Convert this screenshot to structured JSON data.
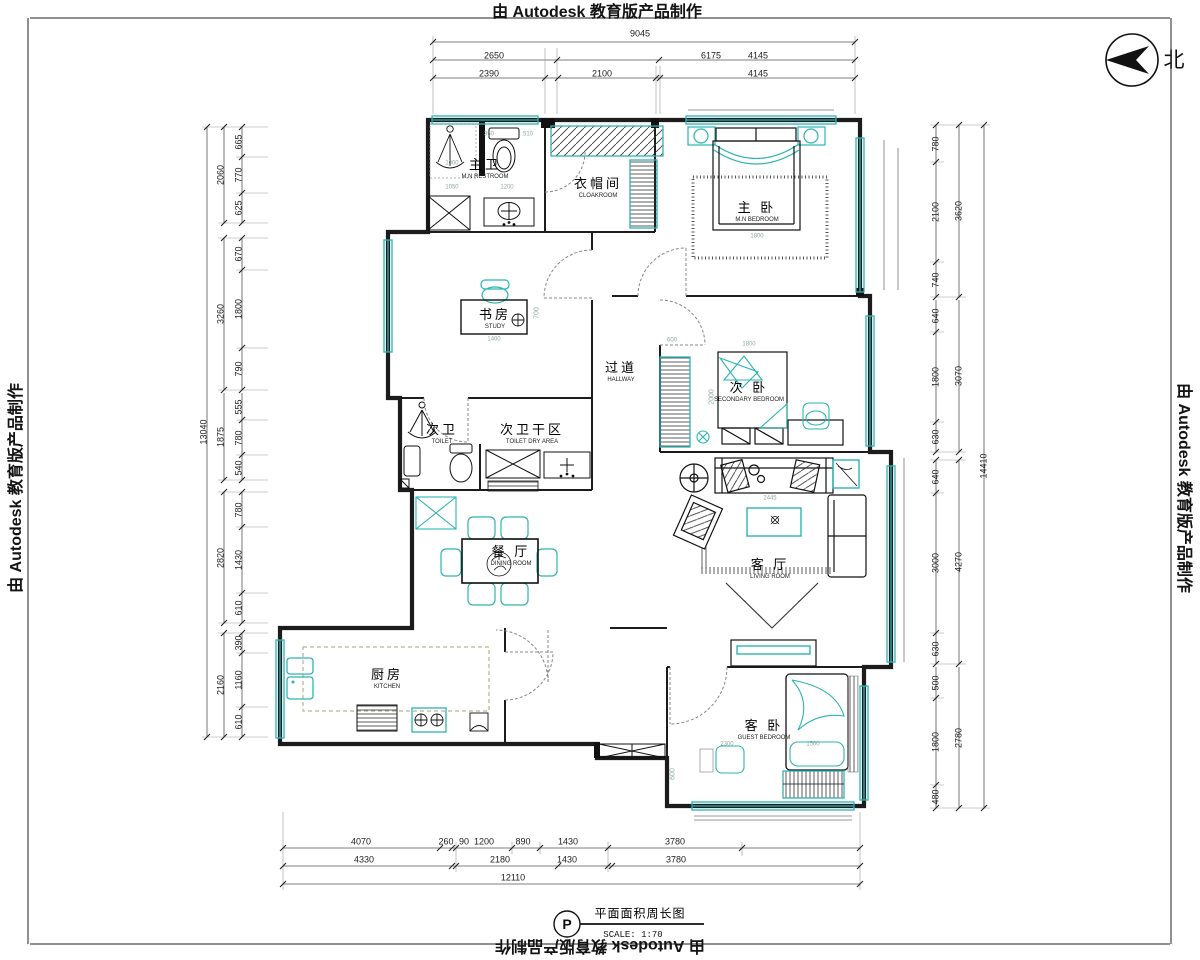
{
  "watermark": {
    "text": "由 Autodesk 教育版产品制作"
  },
  "north": {
    "label": "北"
  },
  "title_block": {
    "symbol": "P",
    "name": "平面面积周长图",
    "scale": "SCALE: 1:70"
  },
  "colors": {
    "furniture": "#2db3b3",
    "walls": "#1c1c1c",
    "dims": "#555555"
  },
  "rooms": [
    {
      "id": "master-restroom",
      "cn": "主卫",
      "en": "M.N RESTROOM",
      "x": 485,
      "y": 169
    },
    {
      "id": "cloakroom",
      "cn": "衣帽间",
      "en": "CLOAKROOM",
      "x": 598,
      "y": 188
    },
    {
      "id": "master-bedroom",
      "cn": "主 卧",
      "en": "M.N BEDROOM",
      "x": 757,
      "y": 212
    },
    {
      "id": "study",
      "cn": "书房",
      "en": "STUDY",
      "x": 495,
      "y": 319
    },
    {
      "id": "hallway",
      "cn": "过道",
      "en": "HALLWAY",
      "x": 621,
      "y": 372
    },
    {
      "id": "secondary-bedroom",
      "cn": "次 卧",
      "en": "SECONDARY BEDROOM",
      "x": 749,
      "y": 392
    },
    {
      "id": "second-toilet",
      "cn": "次卫",
      "en": "TOILET",
      "x": 442,
      "y": 434
    },
    {
      "id": "toilet-dry-area",
      "cn": "次卫干区",
      "en": "TOILET DRY AREA",
      "x": 532,
      "y": 434
    },
    {
      "id": "dining-room",
      "cn": "餐 厅",
      "en": "DINING ROOM",
      "x": 511,
      "y": 556
    },
    {
      "id": "living-room",
      "cn": "客 厅",
      "en": "LIVING ROOM",
      "x": 770,
      "y": 569
    },
    {
      "id": "kitchen",
      "cn": "厨房",
      "en": "KITCHEN",
      "x": 387,
      "y": 679
    },
    {
      "id": "guest-bedroom",
      "cn": "客 卧",
      "en": "GUEST BEDROOM",
      "x": 764,
      "y": 730
    }
  ],
  "dims": {
    "top": [
      {
        "t": "9045",
        "x": 640,
        "y": 34
      },
      {
        "t": "2650",
        "x": 494,
        "y": 56
      },
      {
        "t": "6175",
        "x": 711,
        "y": 56
      },
      {
        "t": "4145",
        "x": 758,
        "y": 56
      },
      {
        "t": "2390",
        "x": 489,
        "y": 74
      },
      {
        "t": "2100",
        "x": 602,
        "y": 74
      },
      {
        "t": "4145",
        "x": 758,
        "y": 74
      }
    ],
    "left": [
      {
        "t": "13040",
        "x": 204,
        "y": 432,
        "r": -90
      },
      {
        "t": "2060",
        "x": 221,
        "y": 175,
        "r": -90
      },
      {
        "t": "3260",
        "x": 221,
        "y": 314,
        "r": -90
      },
      {
        "t": "1875",
        "x": 221,
        "y": 437,
        "r": -90
      },
      {
        "t": "2820",
        "x": 221,
        "y": 558,
        "r": -90
      },
      {
        "t": "2160",
        "x": 221,
        "y": 685,
        "r": -90
      },
      {
        "t": "665",
        "x": 239,
        "y": 142,
        "r": -90
      },
      {
        "t": "770",
        "x": 239,
        "y": 175,
        "r": -90
      },
      {
        "t": "625",
        "x": 239,
        "y": 208,
        "r": -90
      },
      {
        "t": "670",
        "x": 239,
        "y": 254,
        "r": -90
      },
      {
        "t": "1800",
        "x": 239,
        "y": 309,
        "r": -90
      },
      {
        "t": "790",
        "x": 239,
        "y": 369,
        "r": -90
      },
      {
        "t": "555",
        "x": 239,
        "y": 407,
        "r": -90
      },
      {
        "t": "780",
        "x": 239,
        "y": 438,
        "r": -90
      },
      {
        "t": "540",
        "x": 239,
        "y": 468,
        "r": -90
      },
      {
        "t": "780",
        "x": 239,
        "y": 510,
        "r": -90
      },
      {
        "t": "1430",
        "x": 239,
        "y": 560,
        "r": -90
      },
      {
        "t": "610",
        "x": 239,
        "y": 608,
        "r": -90
      },
      {
        "t": "390",
        "x": 239,
        "y": 643,
        "r": -90
      },
      {
        "t": "1160",
        "x": 239,
        "y": 680,
        "r": -90
      },
      {
        "t": "610",
        "x": 239,
        "y": 722,
        "r": -90
      }
    ],
    "right": [
      {
        "t": "14410",
        "x": 984,
        "y": 466,
        "r": -90
      },
      {
        "t": "3620",
        "x": 959,
        "y": 211,
        "r": -90
      },
      {
        "t": "3070",
        "x": 959,
        "y": 376,
        "r": -90
      },
      {
        "t": "4270",
        "x": 959,
        "y": 562,
        "r": -90
      },
      {
        "t": "2780",
        "x": 959,
        "y": 738,
        "r": -90
      },
      {
        "t": "780",
        "x": 936,
        "y": 144,
        "r": -90
      },
      {
        "t": "2100",
        "x": 936,
        "y": 212,
        "r": -90
      },
      {
        "t": "740",
        "x": 936,
        "y": 280,
        "r": -90
      },
      {
        "t": "640",
        "x": 936,
        "y": 316,
        "r": -90
      },
      {
        "t": "1800",
        "x": 936,
        "y": 377,
        "r": -90
      },
      {
        "t": "630",
        "x": 936,
        "y": 437,
        "r": -90
      },
      {
        "t": "640",
        "x": 936,
        "y": 477,
        "r": -90
      },
      {
        "t": "3000",
        "x": 936,
        "y": 563,
        "r": -90
      },
      {
        "t": "630",
        "x": 936,
        "y": 649,
        "r": -90
      },
      {
        "t": "500",
        "x": 936,
        "y": 683,
        "r": -90
      },
      {
        "t": "1800",
        "x": 936,
        "y": 742,
        "r": -90
      },
      {
        "t": "480",
        "x": 936,
        "y": 797,
        "r": -90
      }
    ],
    "bottom": [
      {
        "t": "12110",
        "x": 513,
        "y": 878
      },
      {
        "t": "4330",
        "x": 364,
        "y": 860
      },
      {
        "t": "2180",
        "x": 500,
        "y": 860
      },
      {
        "t": "1430",
        "x": 567,
        "y": 860
      },
      {
        "t": "3780",
        "x": 676,
        "y": 860
      },
      {
        "t": "4070",
        "x": 361,
        "y": 842
      },
      {
        "t": "260",
        "x": 446,
        "y": 842
      },
      {
        "t": "90",
        "x": 464,
        "y": 842
      },
      {
        "t": "1200",
        "x": 484,
        "y": 842
      },
      {
        "t": "890",
        "x": 523,
        "y": 842
      },
      {
        "t": "1430",
        "x": 568,
        "y": 842
      },
      {
        "t": "3780",
        "x": 675,
        "y": 842
      }
    ],
    "internal": [
      {
        "t": "350",
        "x": 489,
        "y": 134
      },
      {
        "t": "510",
        "x": 528,
        "y": 134
      },
      {
        "t": "1000",
        "x": 452,
        "y": 163
      },
      {
        "t": "1050",
        "x": 452,
        "y": 187
      },
      {
        "t": "1200",
        "x": 507,
        "y": 187
      },
      {
        "t": "700",
        "x": 537,
        "y": 313,
        "r": -90
      },
      {
        "t": "1400",
        "x": 494,
        "y": 339
      },
      {
        "t": "1800",
        "x": 757,
        "y": 236
      },
      {
        "t": "600",
        "x": 672,
        "y": 340
      },
      {
        "t": "1800",
        "x": 749,
        "y": 344
      },
      {
        "t": "2000",
        "x": 712,
        "y": 397,
        "r": -90
      },
      {
        "t": "2445",
        "x": 770,
        "y": 498
      },
      {
        "t": "2300",
        "x": 727,
        "y": 744
      },
      {
        "t": "1500",
        "x": 813,
        "y": 744
      },
      {
        "t": "600",
        "x": 673,
        "y": 774,
        "r": -90
      }
    ]
  }
}
